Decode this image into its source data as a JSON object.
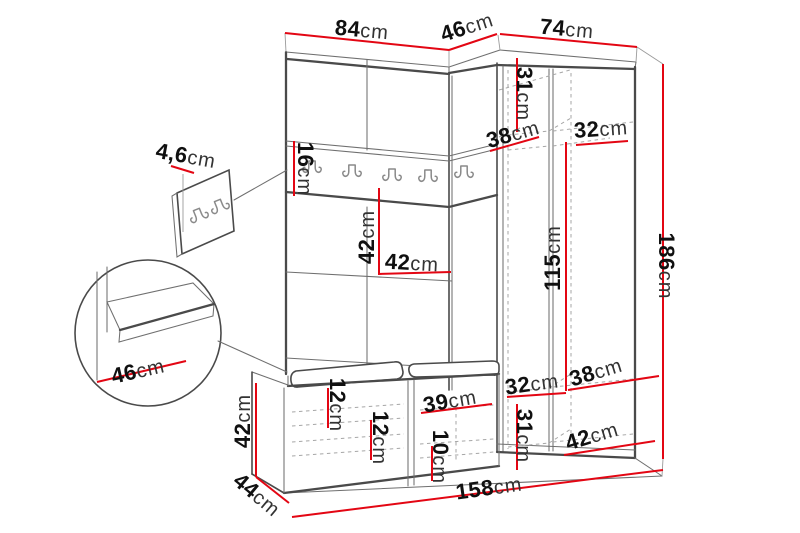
{
  "page": {
    "width": 800,
    "height": 533,
    "background": "#ffffff"
  },
  "colors": {
    "dimension_line": "#e30613",
    "outline": "#4a4a4a",
    "hidden_line": "#a6a6a6",
    "label_number": "#101010",
    "label_unit": "#333333"
  },
  "diagram": {
    "type": "furniture-dimension-diagram",
    "unit": "cm",
    "hook_rail_hook_count": 5,
    "wall_panel_hook_count": 2,
    "labels": [
      {
        "id": "width-left-section",
        "value": "84",
        "unit": "cm",
        "x": 362,
        "y": 30,
        "rotation": 5
      },
      {
        "id": "depth-corner-section",
        "value": "46",
        "unit": "cm",
        "x": 467,
        "y": 27,
        "rotation": -18
      },
      {
        "id": "width-right-section",
        "value": "74",
        "unit": "cm",
        "x": 567,
        "y": 29,
        "rotation": 5
      },
      {
        "id": "panel-thickness",
        "value": "4,6",
        "unit": "cm",
        "x": 186,
        "y": 156,
        "rotation": 10
      },
      {
        "id": "rail-height",
        "value": "16",
        "unit": "cm",
        "x": 305,
        "y": 169,
        "rotation": 90
      },
      {
        "id": "rail-to-shelf-height",
        "value": "42",
        "unit": "cm",
        "x": 367,
        "y": 237,
        "rotation": -90
      },
      {
        "id": "shelf-width",
        "value": "42",
        "unit": "cm",
        "x": 412,
        "y": 263,
        "rotation": 3
      },
      {
        "id": "top-shelf-height",
        "value": "31",
        "unit": "cm",
        "x": 524,
        "y": 94,
        "rotation": 90
      },
      {
        "id": "top-shelf-depth-left",
        "value": "38",
        "unit": "cm",
        "x": 513,
        "y": 134,
        "rotation": -16
      },
      {
        "id": "top-shelf-width-right",
        "value": "32",
        "unit": "cm",
        "x": 601,
        "y": 129,
        "rotation": -4
      },
      {
        "id": "hanging-space-height",
        "value": "115",
        "unit": "cm",
        "x": 553,
        "y": 258,
        "rotation": -90
      },
      {
        "id": "total-height",
        "value": "186",
        "unit": "cm",
        "x": 666,
        "y": 266,
        "rotation": 90
      },
      {
        "id": "bottom-shelf-depth-right",
        "value": "38",
        "unit": "cm",
        "x": 596,
        "y": 372,
        "rotation": -17
      },
      {
        "id": "bottom-shelf-width-left",
        "value": "32",
        "unit": "cm",
        "x": 532,
        "y": 384,
        "rotation": -8
      },
      {
        "id": "bottom-compartment-width",
        "value": "42",
        "unit": "cm",
        "x": 592,
        "y": 436,
        "rotation": -17
      },
      {
        "id": "bottom-compartment-height",
        "value": "31",
        "unit": "cm",
        "x": 524,
        "y": 436,
        "rotation": 90
      },
      {
        "id": "bench-compartment-width",
        "value": "39",
        "unit": "cm",
        "x": 450,
        "y": 401,
        "rotation": -10
      },
      {
        "id": "bench-compartment-height-low",
        "value": "10",
        "unit": "cm",
        "x": 440,
        "y": 457,
        "rotation": 90
      },
      {
        "id": "bench-drawer-height-a",
        "value": "12",
        "unit": "cm",
        "x": 337,
        "y": 405,
        "rotation": 90
      },
      {
        "id": "bench-drawer-height-b",
        "value": "12",
        "unit": "cm",
        "x": 380,
        "y": 438,
        "rotation": 90
      },
      {
        "id": "bench-height",
        "value": "42",
        "unit": "cm",
        "x": 243,
        "y": 421,
        "rotation": -90
      },
      {
        "id": "bench-depth",
        "value": "44",
        "unit": "cm",
        "x": 257,
        "y": 495,
        "rotation": 40
      },
      {
        "id": "total-width",
        "value": "158",
        "unit": "cm",
        "x": 489,
        "y": 488,
        "rotation": -8
      },
      {
        "id": "seat-depth-detail",
        "value": "46",
        "unit": "cm",
        "x": 138,
        "y": 371,
        "rotation": -13
      }
    ]
  }
}
